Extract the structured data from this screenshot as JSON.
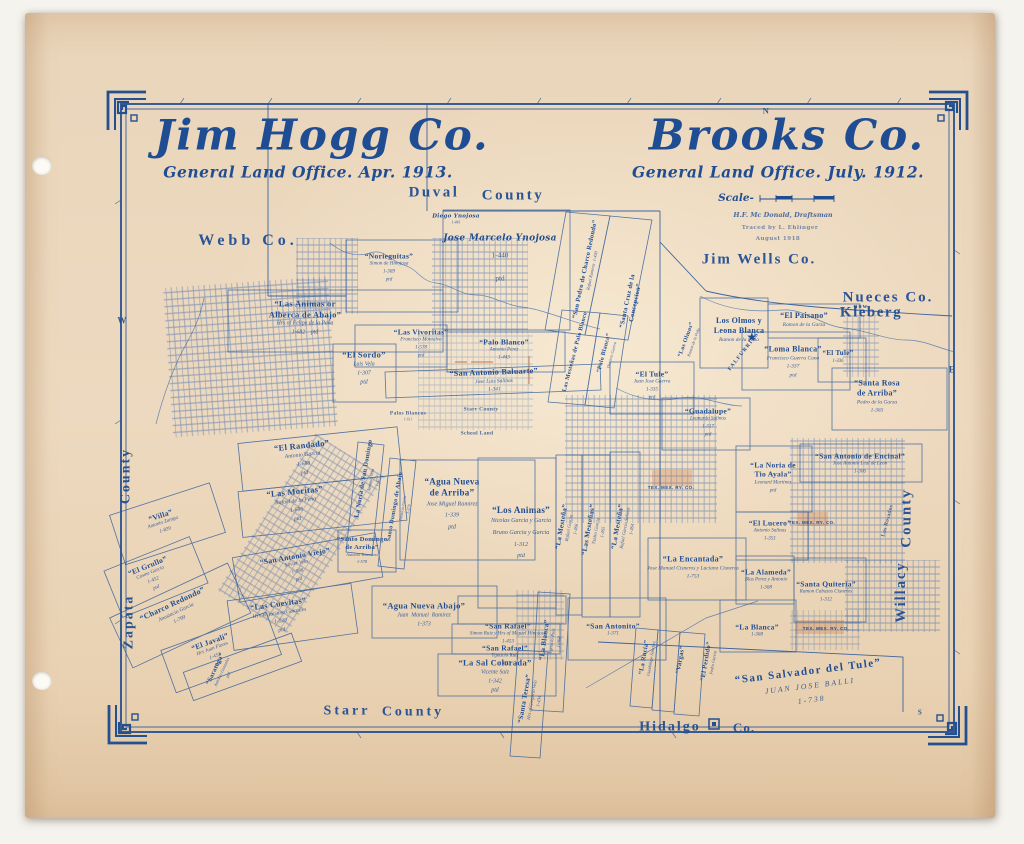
{
  "colors": {
    "ink": "#1f4d94",
    "line": "#3c67a9",
    "accent": "#c2622f",
    "paper": "#ead6ba"
  },
  "titles": {
    "left": {
      "title": "Jim Hogg Co.",
      "subtitle": "General Land Office. Apr. 1913."
    },
    "right": {
      "title": "Brooks Co.",
      "subtitle": "General Land Office. July. 1912."
    }
  },
  "scale": {
    "label": "Scale-",
    "credits": [
      "H.F. Mc Donald, Draftsman",
      "Traced by L. Ehlinger",
      "August 1918"
    ]
  },
  "compass": [
    {
      "t": "N",
      "x": 766,
      "y": 111,
      "fs": 8.5
    },
    {
      "t": "W",
      "x": 122,
      "y": 321,
      "fs": 9
    },
    {
      "t": "E",
      "x": 952,
      "y": 370,
      "fs": 9
    },
    {
      "t": "S",
      "x": 920,
      "y": 713,
      "fs": 7
    }
  ],
  "counties": [
    {
      "t": "Duval",
      "x": 434,
      "y": 193,
      "fs": 15,
      "ls": 2.5
    },
    {
      "t": "County",
      "x": 513,
      "y": 196,
      "fs": 15,
      "ls": 2.5
    },
    {
      "t": "Webb  Co.",
      "x": 248,
      "y": 241,
      "fs": 16,
      "ls": 4
    },
    {
      "t": "Jim Wells  Co.",
      "x": 759,
      "y": 260,
      "fs": 15,
      "ls": 2
    },
    {
      "t": "Nueces  Co.",
      "x": 888,
      "y": 298,
      "fs": 15,
      "ls": 2
    },
    {
      "t": "now",
      "x": 861,
      "y": 307,
      "fs": 6.5,
      "ls": 1
    },
    {
      "t": "Kleberg",
      "x": 871,
      "y": 313,
      "fs": 15,
      "ls": 1.5
    },
    {
      "t": "County",
      "x": 126,
      "y": 476,
      "fs": 14,
      "ls": 2,
      "r": -90
    },
    {
      "t": "Zapata",
      "x": 129,
      "y": 622,
      "fs": 14,
      "ls": 2,
      "r": -90
    },
    {
      "t": "Starr",
      "x": 347,
      "y": 711,
      "fs": 14,
      "ls": 3
    },
    {
      "t": "County",
      "x": 413,
      "y": 712,
      "fs": 14,
      "ls": 3
    },
    {
      "t": "Hidalgo",
      "x": 670,
      "y": 727,
      "fs": 14,
      "ls": 2
    },
    {
      "t": "Co.",
      "x": 744,
      "y": 728,
      "fs": 13,
      "ls": 1
    },
    {
      "t": "County",
      "x": 907,
      "y": 518,
      "fs": 15,
      "ls": 2,
      "r": -90
    },
    {
      "t": "Willacy",
      "x": 901,
      "y": 592,
      "fs": 14.5,
      "ls": 2,
      "r": -90
    }
  ],
  "surveys": [
    {
      "t": "“Norieguitas”",
      "s": [
        "Simon de Hinojosa",
        "1-369",
        "ptd"
      ],
      "x": 389,
      "y": 268,
      "fs": 7.5
    },
    {
      "t": "Diego Ynojosa",
      "s": [
        "1-441"
      ],
      "x": 456,
      "y": 220,
      "fs": 5.5,
      "cls": "script"
    },
    {
      "t": "Jose Marcelo Ynojosa",
      "s": [
        "1-440",
        "ptd"
      ],
      "x": 500,
      "y": 262,
      "fs": 9,
      "cls": "script sp3"
    },
    {
      "t": "“Las Animas or\nAlberca de Abajo”",
      "s": [
        "Hrs of Felipe de la Peña",
        "1-682    ptd"
      ],
      "x": 305,
      "y": 318,
      "fs": 8.5
    },
    {
      "t": "“Las Vivoritas”",
      "s": [
        "Francisco Montalvo",
        "1-578",
        "ptd"
      ],
      "x": 421,
      "y": 344,
      "fs": 7.5
    },
    {
      "t": "“El Sordo”",
      "s": [
        "Luis Vela",
        "1-307",
        "ptd"
      ],
      "x": 364,
      "y": 368,
      "fs": 8.5
    },
    {
      "t": "“Palo Blanco”",
      "s": [
        "Antonio Perez",
        "1-443"
      ],
      "x": 504,
      "y": 350,
      "fs": 7.5
    },
    {
      "t": "“San Antonio Baluarte”",
      "s": [
        "Jose Luis Salinas",
        "1-341"
      ],
      "x": 494,
      "y": 381,
      "r": -2,
      "fs": 8
    },
    {
      "t": "“San Pedro de Charco Redondo”",
      "s": [
        "Rafael Ramirez  1-430"
      ],
      "x": 589,
      "y": 270,
      "r": -78,
      "fs": 6.5
    },
    {
      "t": "“Santa Cruz de la\nConcepcion”",
      "x": 632,
      "y": 302,
      "r": -78,
      "fs": 6.5
    },
    {
      "t": "Palos Blancos",
      "s": [
        "1-611"
      ],
      "x": 408,
      "y": 417,
      "fs": 5.5,
      "cls": "tiny"
    },
    {
      "t": "Starr County",
      "x": 481,
      "y": 410,
      "fs": 5.5,
      "cls": "tiny"
    },
    {
      "t": "School Land",
      "x": 477,
      "y": 434,
      "fs": 5.5,
      "cls": "tiny"
    },
    {
      "t": "Las Mesteñas de Palo Blanco",
      "x": 576,
      "y": 352,
      "r": -75,
      "fs": 6
    },
    {
      "t": "“Palo Blanco”",
      "s": [
        "Dionicio Guerra"
      ],
      "x": 608,
      "y": 354,
      "r": -75,
      "fs": 6
    },
    {
      "t": "“Los Olmos”",
      "s": [
        "Ramon de la Peña"
      ],
      "x": 690,
      "y": 341,
      "r": -70,
      "fs": 6
    },
    {
      "t": "“El Tule”",
      "s": [
        "Juan Jose Guerra",
        "1-335",
        "ptd"
      ],
      "x": 652,
      "y": 386,
      "fs": 7.5
    },
    {
      "t": "“Guadalupe”",
      "s": [
        "Leonardo Salinas",
        "1-317",
        "ptd"
      ],
      "x": 708,
      "y": 423,
      "fs": 7.5
    },
    {
      "t": "Los Olmos y\nLeona Blanca",
      "s": [
        "Ramon de la Peña"
      ],
      "x": 739,
      "y": 330,
      "fs": 8
    },
    {
      "t": "“El Paisano”",
      "s": [
        "Ramon de la Garza"
      ],
      "x": 804,
      "y": 320,
      "fs": 8
    },
    {
      "t": "★",
      "x": 752,
      "y": 338,
      "fs": 10,
      "cls": "star",
      "dn": "falfurrias-star-icon"
    },
    {
      "t": "FALFURRIAS",
      "x": 744,
      "y": 352,
      "r": -52,
      "fs": 5.5,
      "cls": "caps"
    },
    {
      "t": "“Loma Blanca”",
      "s": [
        "Francisco Guerra Cano",
        "1-337",
        "ptd"
      ],
      "x": 793,
      "y": 362,
      "fs": 8
    },
    {
      "t": "“El Tule”",
      "s": [
        "1-336"
      ],
      "x": 838,
      "y": 357,
      "fs": 7
    },
    {
      "t": "“Santa Rosa\nde Arriba”",
      "s": [
        "Pedro de la Garza",
        "1-365"
      ],
      "x": 877,
      "y": 397,
      "fs": 8
    },
    {
      "t": "“La Noria de\nTio Ayala”",
      "s": [
        "Leonard Martinez",
        "ptd"
      ],
      "x": 773,
      "y": 478,
      "fs": 7.5
    },
    {
      "t": "“San Antonio de Encinal”",
      "s": [
        "Jose Antonio Leal de Leon",
        "1-306"
      ],
      "x": 860,
      "y": 464,
      "fs": 7.5
    },
    {
      "t": "“El Lucero”",
      "s": [
        "Antonio Salinas",
        "1-351"
      ],
      "x": 770,
      "y": 531,
      "fs": 7.5
    },
    {
      "t": "TEX. MEX. RY. CO.",
      "x": 671,
      "y": 488,
      "fs": 4.5,
      "cls": "rr"
    },
    {
      "t": "TEX. MEX. RY. CO.",
      "x": 812,
      "y": 523,
      "fs": 4.5,
      "cls": "rr"
    },
    {
      "t": "TEX. MEX. RY. CO.",
      "x": 826,
      "y": 629,
      "fs": 4.5,
      "cls": "rr"
    },
    {
      "t": "Los Rosados",
      "x": 888,
      "y": 521,
      "r": -75,
      "fs": 5.5,
      "cls": "tiny"
    },
    {
      "t": "“La Encantada”",
      "s": [
        "Jose Manuel Cisneros y Luciana Cisneros",
        "1-753"
      ],
      "x": 693,
      "y": 568,
      "fs": 8
    },
    {
      "t": "“La Alameda”",
      "s": [
        "Blas Perez y Antonio",
        "1-368"
      ],
      "x": 766,
      "y": 580,
      "fs": 7.5
    },
    {
      "t": "“Santa Quiteria”",
      "s": [
        "Ramon Cabazos Cisneros",
        "1-312"
      ],
      "x": 826,
      "y": 592,
      "fs": 7.5
    },
    {
      "t": "“La Blanca”",
      "s": [
        "Ygnacio Ruiz",
        "1-368"
      ],
      "x": 552,
      "y": 641,
      "r": -82,
      "fs": 7
    },
    {
      "t": "“San Antonito”",
      "s": [
        "1-371"
      ],
      "x": 613,
      "y": 630,
      "fs": 7.5
    },
    {
      "t": "“La Rucia”",
      "s": [
        "Guadalupe Sanchez"
      ],
      "x": 648,
      "y": 658,
      "r": -80,
      "fs": 6.5
    },
    {
      "t": "“Vargas”",
      "x": 681,
      "y": 660,
      "r": -80,
      "fs": 6.5
    },
    {
      "t": "“El Perdido”",
      "s": [
        "Pedro Garcia"
      ],
      "x": 710,
      "y": 662,
      "r": -80,
      "fs": 6.5
    },
    {
      "t": "“La Blanca”",
      "s": [
        "1-368"
      ],
      "x": 757,
      "y": 631,
      "fs": 7.5
    },
    {
      "t": "“San Salvador del Tule”",
      "s": [
        "JUAN JOSE BALLI",
        "1-738"
      ],
      "x": 810,
      "y": 686,
      "r": -7,
      "fs": 11,
      "cls": "big"
    },
    {
      "t": "“El Randado”",
      "s": [
        "Antonio Garcia",
        "1-688",
        "ptd"
      ],
      "x": 303,
      "y": 459,
      "r": -6,
      "fs": 8.5
    },
    {
      "t": "“Las Moritas”",
      "s": [
        "Rafael de la Peña",
        "1-686",
        "ptd"
      ],
      "x": 296,
      "y": 505,
      "r": -6,
      "fs": 8.5
    },
    {
      "t": "“Villa”",
      "s": [
        "Antonio Zuniga",
        "1-839"
      ],
      "x": 163,
      "y": 523,
      "r": -18,
      "fs": 7.5
    },
    {
      "t": "La Noria de San Domingo",
      "s": [
        "Antonio Vela",
        "1-377"
      ],
      "x": 371,
      "y": 480,
      "r": -80,
      "fs": 6.5
    },
    {
      "t": "Santo Domingo de Abajo",
      "s": [
        "Dionicio Garza",
        "1-379"
      ],
      "x": 402,
      "y": 508,
      "r": -80,
      "fs": 6
    },
    {
      "t": "“Santo Domingo\nde Arriba”",
      "s": [
        "Antonio Tenecano",
        "1-578"
      ],
      "x": 362,
      "y": 551,
      "fs": 6.5
    },
    {
      "t": "“San Antonio Viejo”",
      "s": [
        "Xavier Vela",
        "1-588",
        "ptd"
      ],
      "x": 297,
      "y": 568,
      "r": -10,
      "fs": 7.5
    },
    {
      "t": "“El Grullo”",
      "s": [
        "Cosme Garcia",
        "1-452",
        "ptd"
      ],
      "x": 152,
      "y": 577,
      "r": -22,
      "fs": 7.5
    },
    {
      "t": "“Charco Redondo”",
      "s": [
        "Anastacio Garcia",
        "1-799"
      ],
      "x": 176,
      "y": 612,
      "r": -25,
      "fs": 8
    },
    {
      "t": "“Las Cuevitas”",
      "s": [
        "Hrs Victoriano Gonzales",
        "1-528",
        "ptd"
      ],
      "x": 280,
      "y": 617,
      "r": -8,
      "fs": 8
    },
    {
      "t": "“El Javali”",
      "s": [
        "Hrs Juan Flores",
        "1-453",
        "ptd"
      ],
      "x": 214,
      "y": 653,
      "r": -20,
      "fs": 7.5
    },
    {
      "t": "“Saratoga”",
      "s": [
        "Antonio Gonzales",
        "ptd"
      ],
      "x": 222,
      "y": 672,
      "r": -65,
      "fs": 6.5
    },
    {
      "t": "“Agua Nueva\nde Arriba”",
      "s": [
        "Jose Miguel Ramirez",
        "1-339",
        "ptd"
      ],
      "x": 452,
      "y": 505,
      "fs": 9,
      "cls": "sp2"
    },
    {
      "t": "“Los Animas”",
      "s": [
        "Nicolas Garcia y Garcia",
        "Bruno Garcia y Garcia",
        "1-312",
        "ptd"
      ],
      "x": 521,
      "y": 534,
      "fs": 9,
      "cls": "sp2"
    },
    {
      "t": "“La Mesteña”",
      "s": [
        "Rafael Garcia",
        "1-366"
      ],
      "x": 569,
      "y": 528,
      "r": -80,
      "fs": 7
    },
    {
      "t": "“Las Mesteñas”",
      "s": [
        "Ysidro Garcia",
        "1-365"
      ],
      "x": 596,
      "y": 531,
      "r": -80,
      "fs": 7
    },
    {
      "t": "“La Mesteña”",
      "s": [
        "Rafael Garcia Salinas",
        "1-364"
      ],
      "x": 625,
      "y": 528,
      "r": -80,
      "fs": 7
    },
    {
      "t": "“Agua Nueva Abajo”",
      "s": [
        "Juan  Manuel  Ramirez",
        "1-373"
      ],
      "x": 424,
      "y": 615,
      "fs": 8.5
    },
    {
      "t": "“San Rafael”",
      "s": [
        "Simon Ruiz y Hrs of Miguel Hinojosa",
        "1-453"
      ],
      "x": 508,
      "y": 634,
      "fs": 7.5
    },
    {
      "t": "“San Rafael”",
      "s": [
        "Ygnacio Ruiz",
        "1-633"
      ],
      "x": 505,
      "y": 656,
      "fs": 7.5
    },
    {
      "t": "“La Sal Colorada”",
      "s": [
        "Vicente Saiz",
        "1-342",
        "ptd"
      ],
      "x": 495,
      "y": 676,
      "fs": 8.5
    },
    {
      "t": "“Santa Teresa”",
      "s": [
        "Hrs of Gregorio Vela",
        "1-434"
      ],
      "x": 532,
      "y": 700,
      "r": -80,
      "fs": 7
    }
  ]
}
